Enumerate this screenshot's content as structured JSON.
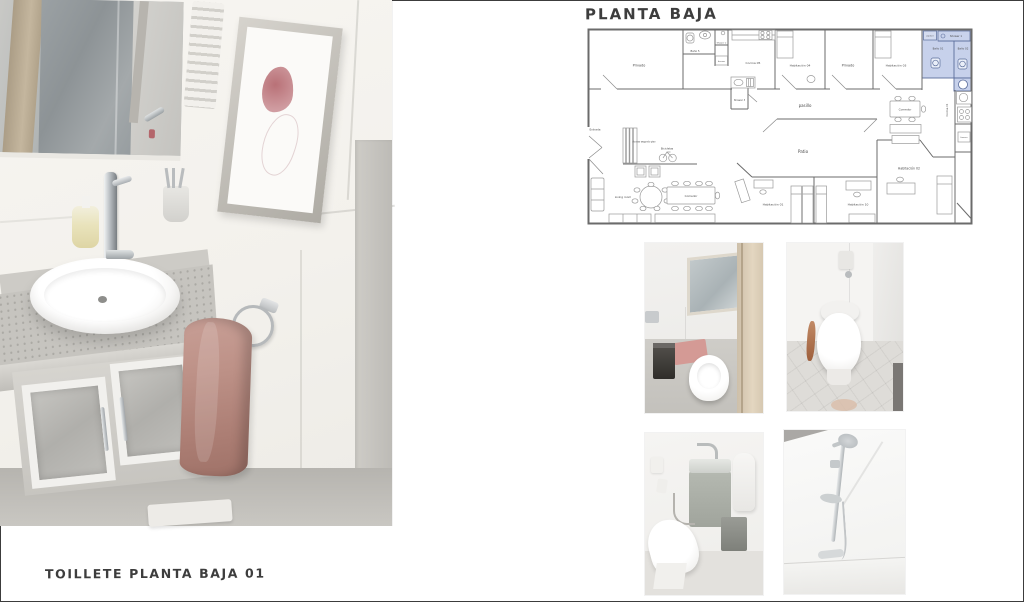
{
  "page": {
    "title": "PLANTA BAJA",
    "caption": "TOILLETE PLANTA BAJA 01"
  },
  "plan": {
    "labels": {
      "privado_left": "Privado",
      "bano_5": "Baño 5",
      "shower_2": "Shower 2",
      "freezer_top": "freezer",
      "cocina_05": "Cocina 05",
      "shower_3": "Shower 3",
      "habitacion_04": "Habitación 04",
      "privado_right": "Privado",
      "habitacion_03": "Habitación 03",
      "washer": "washer",
      "shower_1": "Shower 1",
      "bano_01": "Baño 01",
      "bano_02": "Baño 02",
      "pasillo": "pasillo",
      "comedor_right": "Comedor",
      "cocina_01": "Cocina 01",
      "freezer_right": "freezer",
      "patio": "Patio",
      "habitacion_02": "Habitación 02",
      "habitacion_01": "Habitación 01",
      "habitacion_10": "Habitación 10",
      "entrada": "Entrada",
      "acceso": "Acceso segundo piso",
      "bicicletas": "Bicicletas",
      "living_room": "Living room",
      "comedor_left": "Comedor"
    },
    "highlight_color": "#bdc9e7"
  },
  "colors": {
    "plan_highlight": "#bdc9e7",
    "towel": "#bd9187",
    "bath_mat": "#d49a95",
    "door_wood": "#d9cab2"
  }
}
